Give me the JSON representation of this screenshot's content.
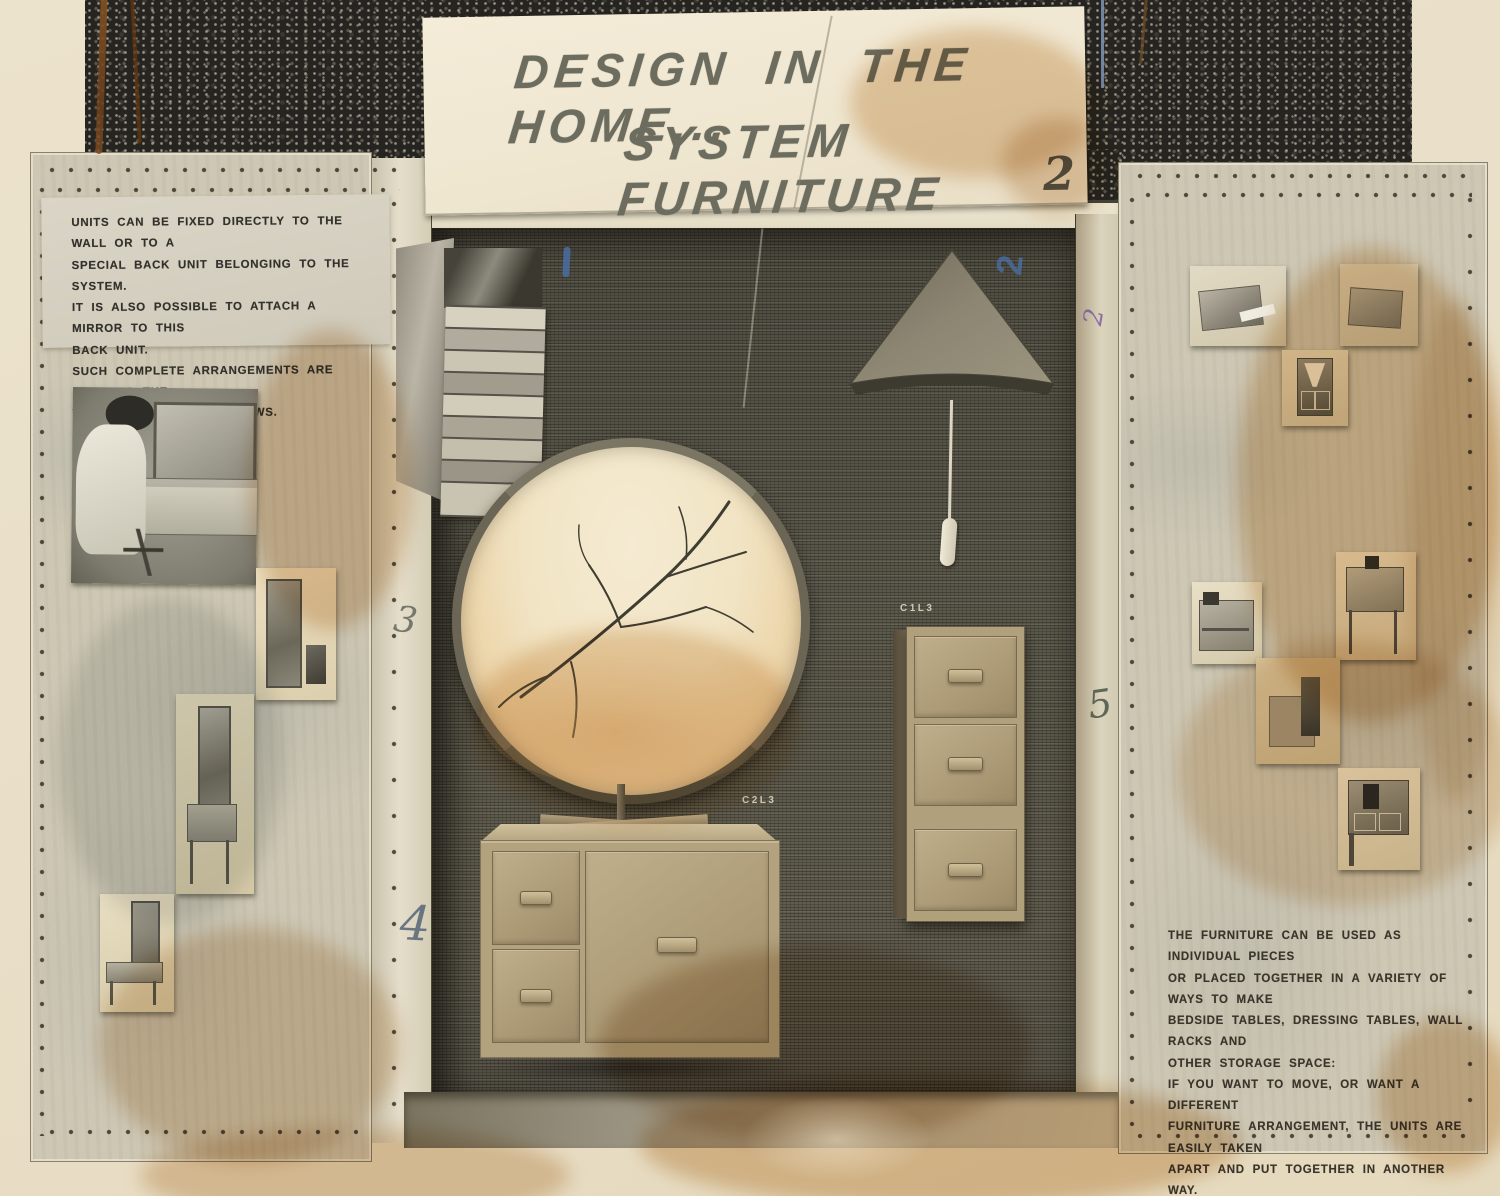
{
  "sign": {
    "title_line1": "DESIGN IN THE HOME...",
    "title_line2": "SYSTEM FURNITURE",
    "number": "2"
  },
  "left_panel": {
    "caption": "UNITS CAN BE FIXED DIRECTLY TO THE WALL OR TO A\nSPECIAL BACK UNIT BELONGING TO THE SYSTEM.\nIT IS ALSO POSSIBLE TO ATTACH A MIRROR TO THIS\nBACK UNIT.\nSUCH COMPLETE ARRANGEMENTS ARE FIXED TO THE\nWALL BY ONLY TWO SCREWS."
  },
  "right_panel": {
    "caption": "THE FURNITURE CAN BE USED AS INDIVIDUAL PIECES\nOR PLACED TOGETHER IN A VARIETY OF WAYS TO MAKE\nBEDSIDE TABLES, DRESSING TABLES, WALL RACKS AND\nOTHER STORAGE SPACE:\nIF YOU WANT TO MOVE, OR WANT A DIFFERENT\nFURNITURE ARRANGEMENT, THE UNITS ARE EASILY TAKEN\nAPART AND PUT TOGETHER IN ANOTHER WAY."
  },
  "product_labels": {
    "wall_unit": "C1L3",
    "cabinet": "C2L3"
  },
  "handwritten_marks": {
    "blue_numeral": "2",
    "purple_numeral": "2",
    "pencil_three": "3",
    "pencil_four": "4",
    "pencil_five": "5"
  },
  "colors": {
    "paper": "#e9dfc8",
    "granite": "#262420",
    "burlap": "#575449",
    "wood": "#b3a37f",
    "sign_text": "#6c6c5f",
    "caption_ink": "#31302a",
    "blue_pen": "#4a71a8",
    "purple_pen": "#7a55a0"
  }
}
